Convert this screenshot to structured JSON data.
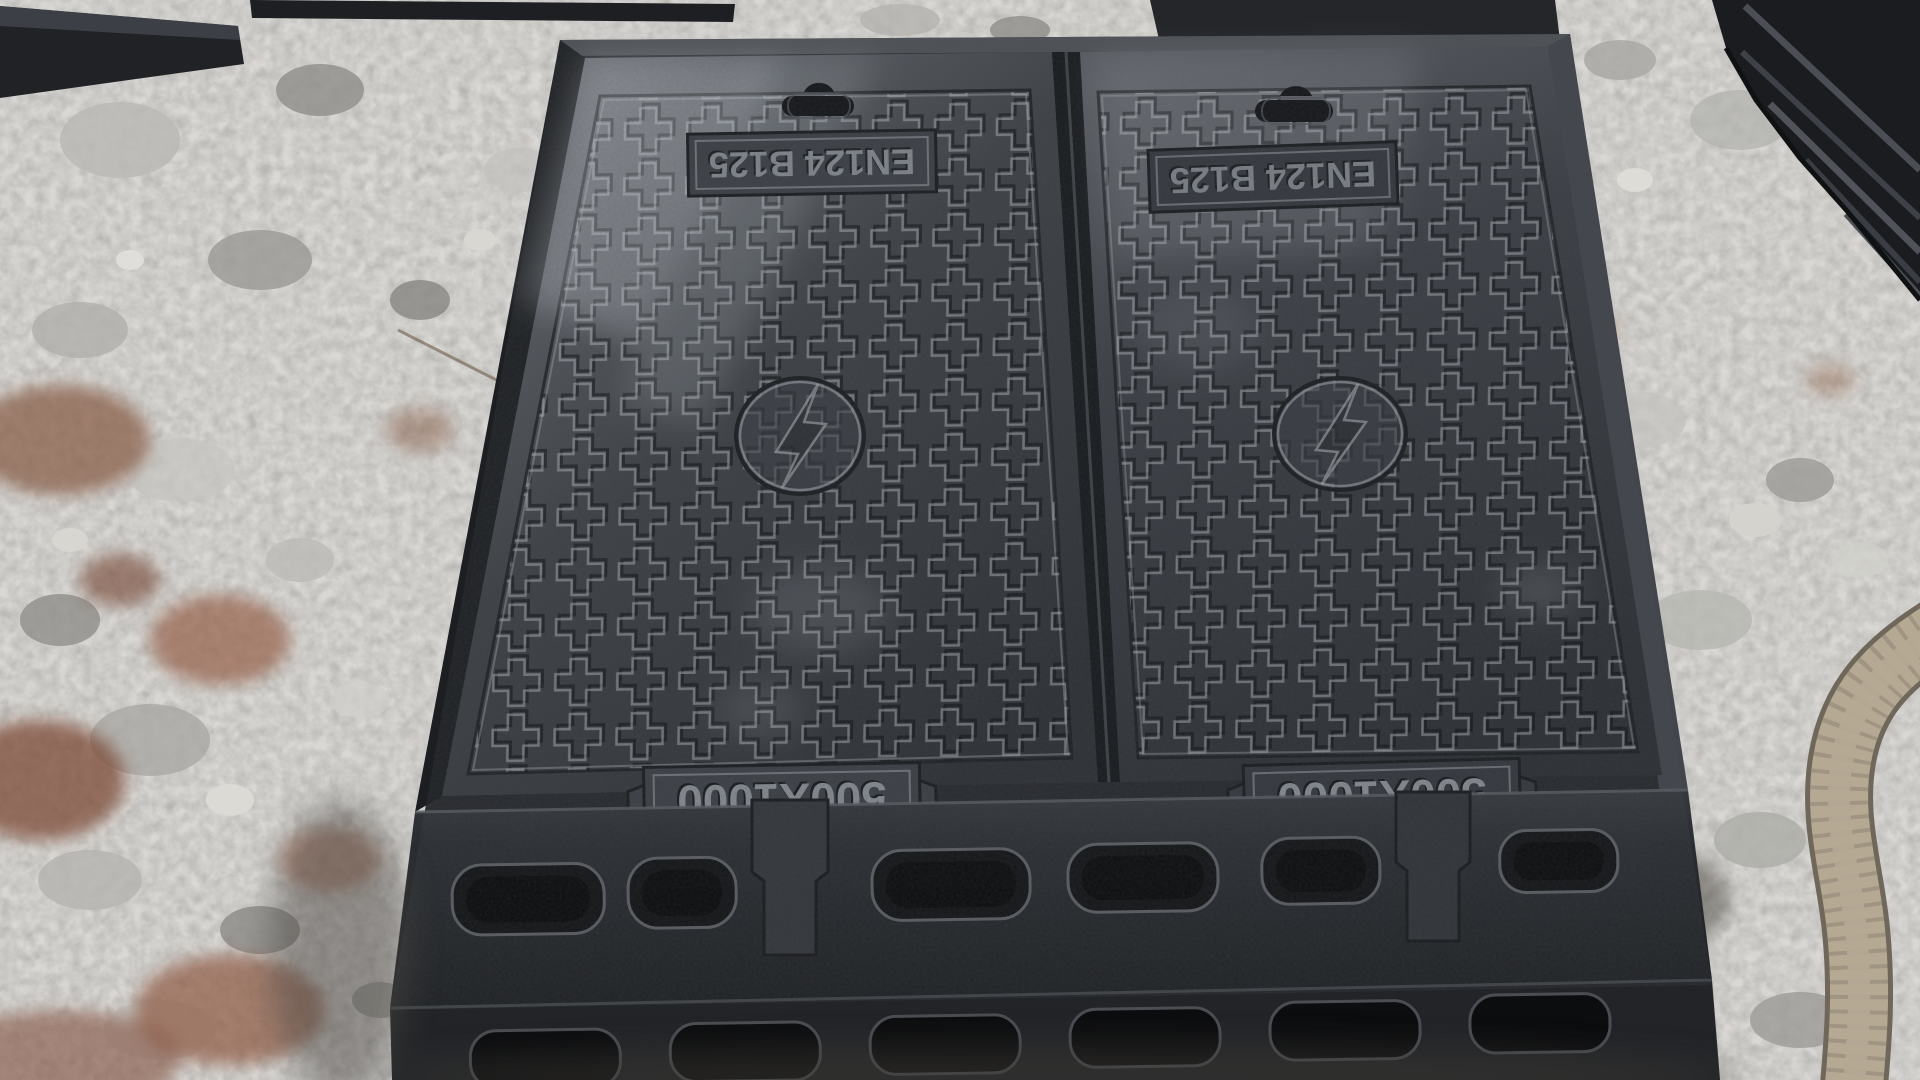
{
  "markings": {
    "left_cover": {
      "standard": "EN124 B125",
      "size": "500X1000"
    },
    "right_cover": {
      "standard": "EN124 B125",
      "size": "500X1000"
    }
  },
  "emblem": {
    "name": "lightning-bolt"
  },
  "colors": {
    "cover_base": "#33363c",
    "cover_dark": "#2b2e33",
    "cover_sheen": "#9aa0a6",
    "frame": "#26282c",
    "slot_dark": "#0d0e10",
    "gravel_base": "#a6a5a2",
    "rust_debris": "#8a5f4a",
    "hose": "#b5a994",
    "emboss_light": "#b4b9bf"
  }
}
